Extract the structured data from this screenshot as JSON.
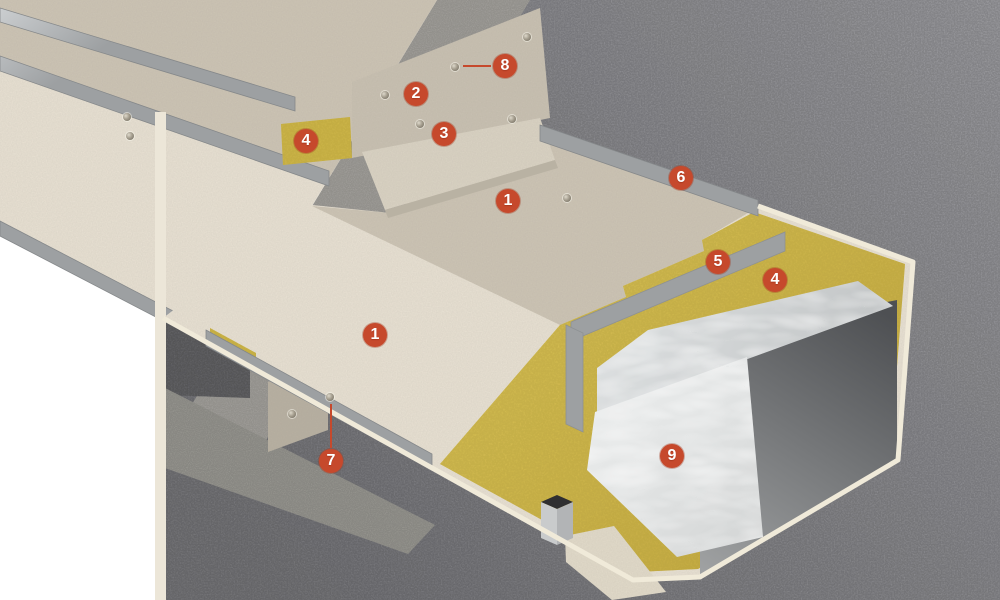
{
  "figure": {
    "type": "technical-illustration",
    "subject": "fire-protected rectangular duct penetrating a concrete wall, cutaway view",
    "colors": {
      "page_background": "#ffffff",
      "concrete_wall": "#88888c",
      "concrete_cut_face": "#a7a5a0",
      "board_top": "#cdc5b5",
      "board_front": "#e9e2d4",
      "board_edge": "#efe9dc",
      "mineral_wool": "#d3ba4a",
      "steel_strip": "#b4b7b9",
      "duct_metal": "#e4e6e6",
      "duct_interior": "#5a5c5f",
      "marker_accent": "#c6492c"
    },
    "markers": [
      {
        "label": "1",
        "x": 508,
        "y": 201
      },
      {
        "label": "1",
        "x": 375,
        "y": 335
      },
      {
        "label": "2",
        "x": 416,
        "y": 94
      },
      {
        "label": "3",
        "x": 444,
        "y": 134
      },
      {
        "label": "4",
        "x": 306,
        "y": 141
      },
      {
        "label": "4",
        "x": 775,
        "y": 280
      },
      {
        "label": "5",
        "x": 718,
        "y": 262
      },
      {
        "label": "6",
        "x": 681,
        "y": 178
      },
      {
        "label": "7",
        "x": 331,
        "y": 461
      },
      {
        "label": "8",
        "x": 505,
        "y": 66
      },
      {
        "label": "9",
        "x": 672,
        "y": 456
      }
    ],
    "leaders": [
      {
        "x": 463,
        "y": 65,
        "length": 28,
        "direction": "horizontal"
      },
      {
        "x": 330,
        "y": 404,
        "length": 44,
        "direction": "vertical"
      }
    ],
    "screws": [
      {
        "x": 385,
        "y": 95
      },
      {
        "x": 455,
        "y": 67
      },
      {
        "x": 527,
        "y": 37
      },
      {
        "x": 420,
        "y": 124
      },
      {
        "x": 512,
        "y": 119
      },
      {
        "x": 127,
        "y": 117
      },
      {
        "x": 130,
        "y": 136
      },
      {
        "x": 567,
        "y": 198
      },
      {
        "x": 292,
        "y": 414
      },
      {
        "x": 330,
        "y": 397
      }
    ]
  }
}
